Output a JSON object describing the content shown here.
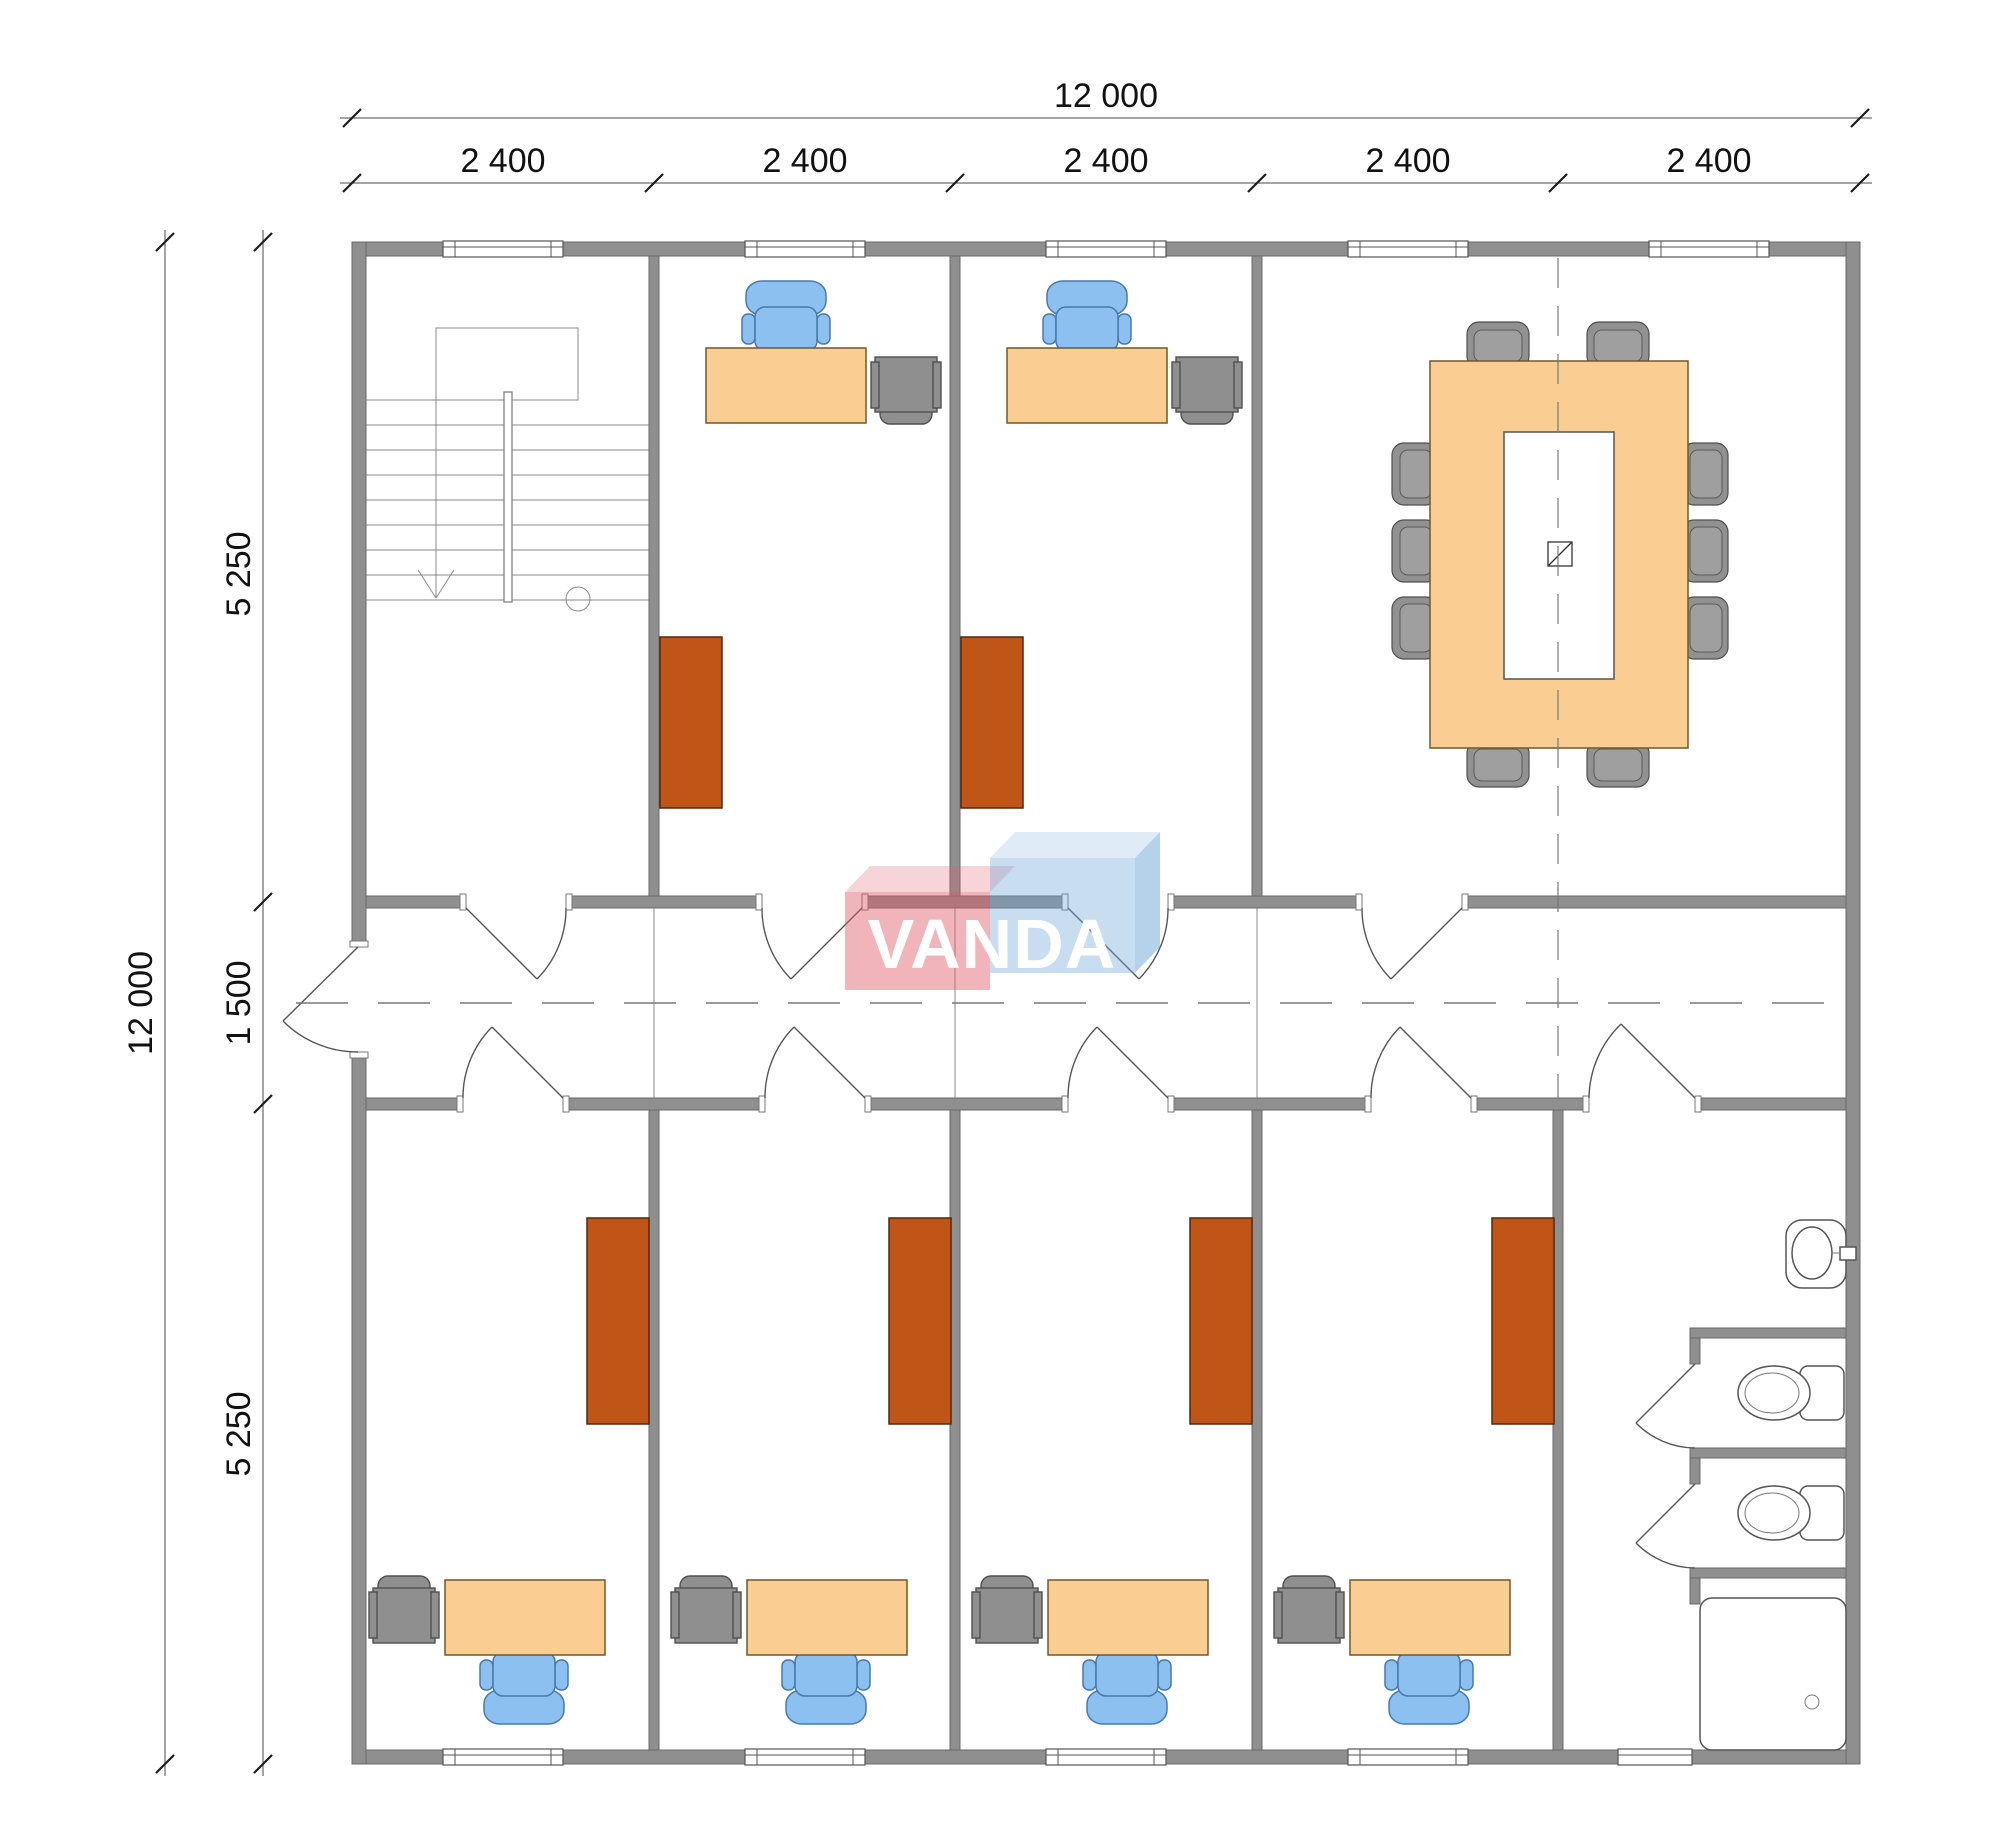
{
  "dimensions": {
    "overall_width": "12 000",
    "column_segments": [
      "2 400",
      "2 400",
      "2 400",
      "2 400",
      "2 400"
    ],
    "overall_height": "12 000",
    "row_segments": [
      "5 250",
      "1 500",
      "5 250"
    ]
  },
  "logo": {
    "text": "VANDA"
  },
  "colors": {
    "wall": "#8F8F8F",
    "desk": "#FACD92",
    "chair_blue": "#8CC0F0",
    "cabinet_rust": "#BF5517",
    "cabinet_gray": "#8F8F8F",
    "logo_pink": "#E25869",
    "logo_blue": "#6EA5D7"
  }
}
